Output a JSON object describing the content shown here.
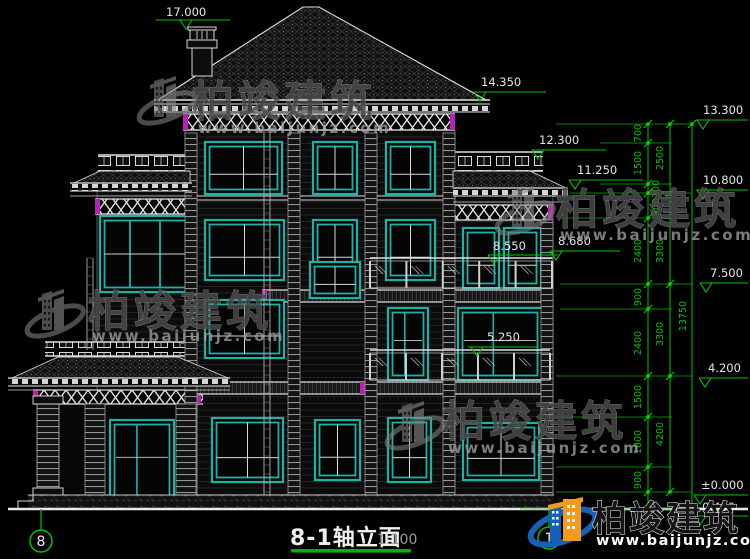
{
  "drawing": {
    "title": "8-1轴立面",
    "scale": "1:100",
    "axis_left": "8",
    "axis_right": "1"
  },
  "levels": {
    "top": "17.000",
    "main_eave": "14.350",
    "l13300": "13.300",
    "l12300": "12.300",
    "l11250": "11.250",
    "l10800": "10.800",
    "l8680": "8.680",
    "l8550": "8.550",
    "l7500": "7.500",
    "l5250": "5.250",
    "l4200": "4.200",
    "zero": "±0.000",
    "ground": "-0.450"
  },
  "dims": {
    "col1": [
      "700",
      "1500",
      "300",
      "900",
      "2400",
      "900",
      "2400",
      "1500",
      "1800",
      "900"
    ],
    "col2": [
      "2500",
      "3300",
      "3300",
      "4200"
    ],
    "total": "13750"
  },
  "watermark": {
    "brand": "柏竣建筑",
    "url": "www.baijunjz.com"
  },
  "colors": {
    "teal": "#1BB3A8",
    "green": "#00C400",
    "magenta": "#BB1FBB",
    "white": "#E6E6E6"
  }
}
